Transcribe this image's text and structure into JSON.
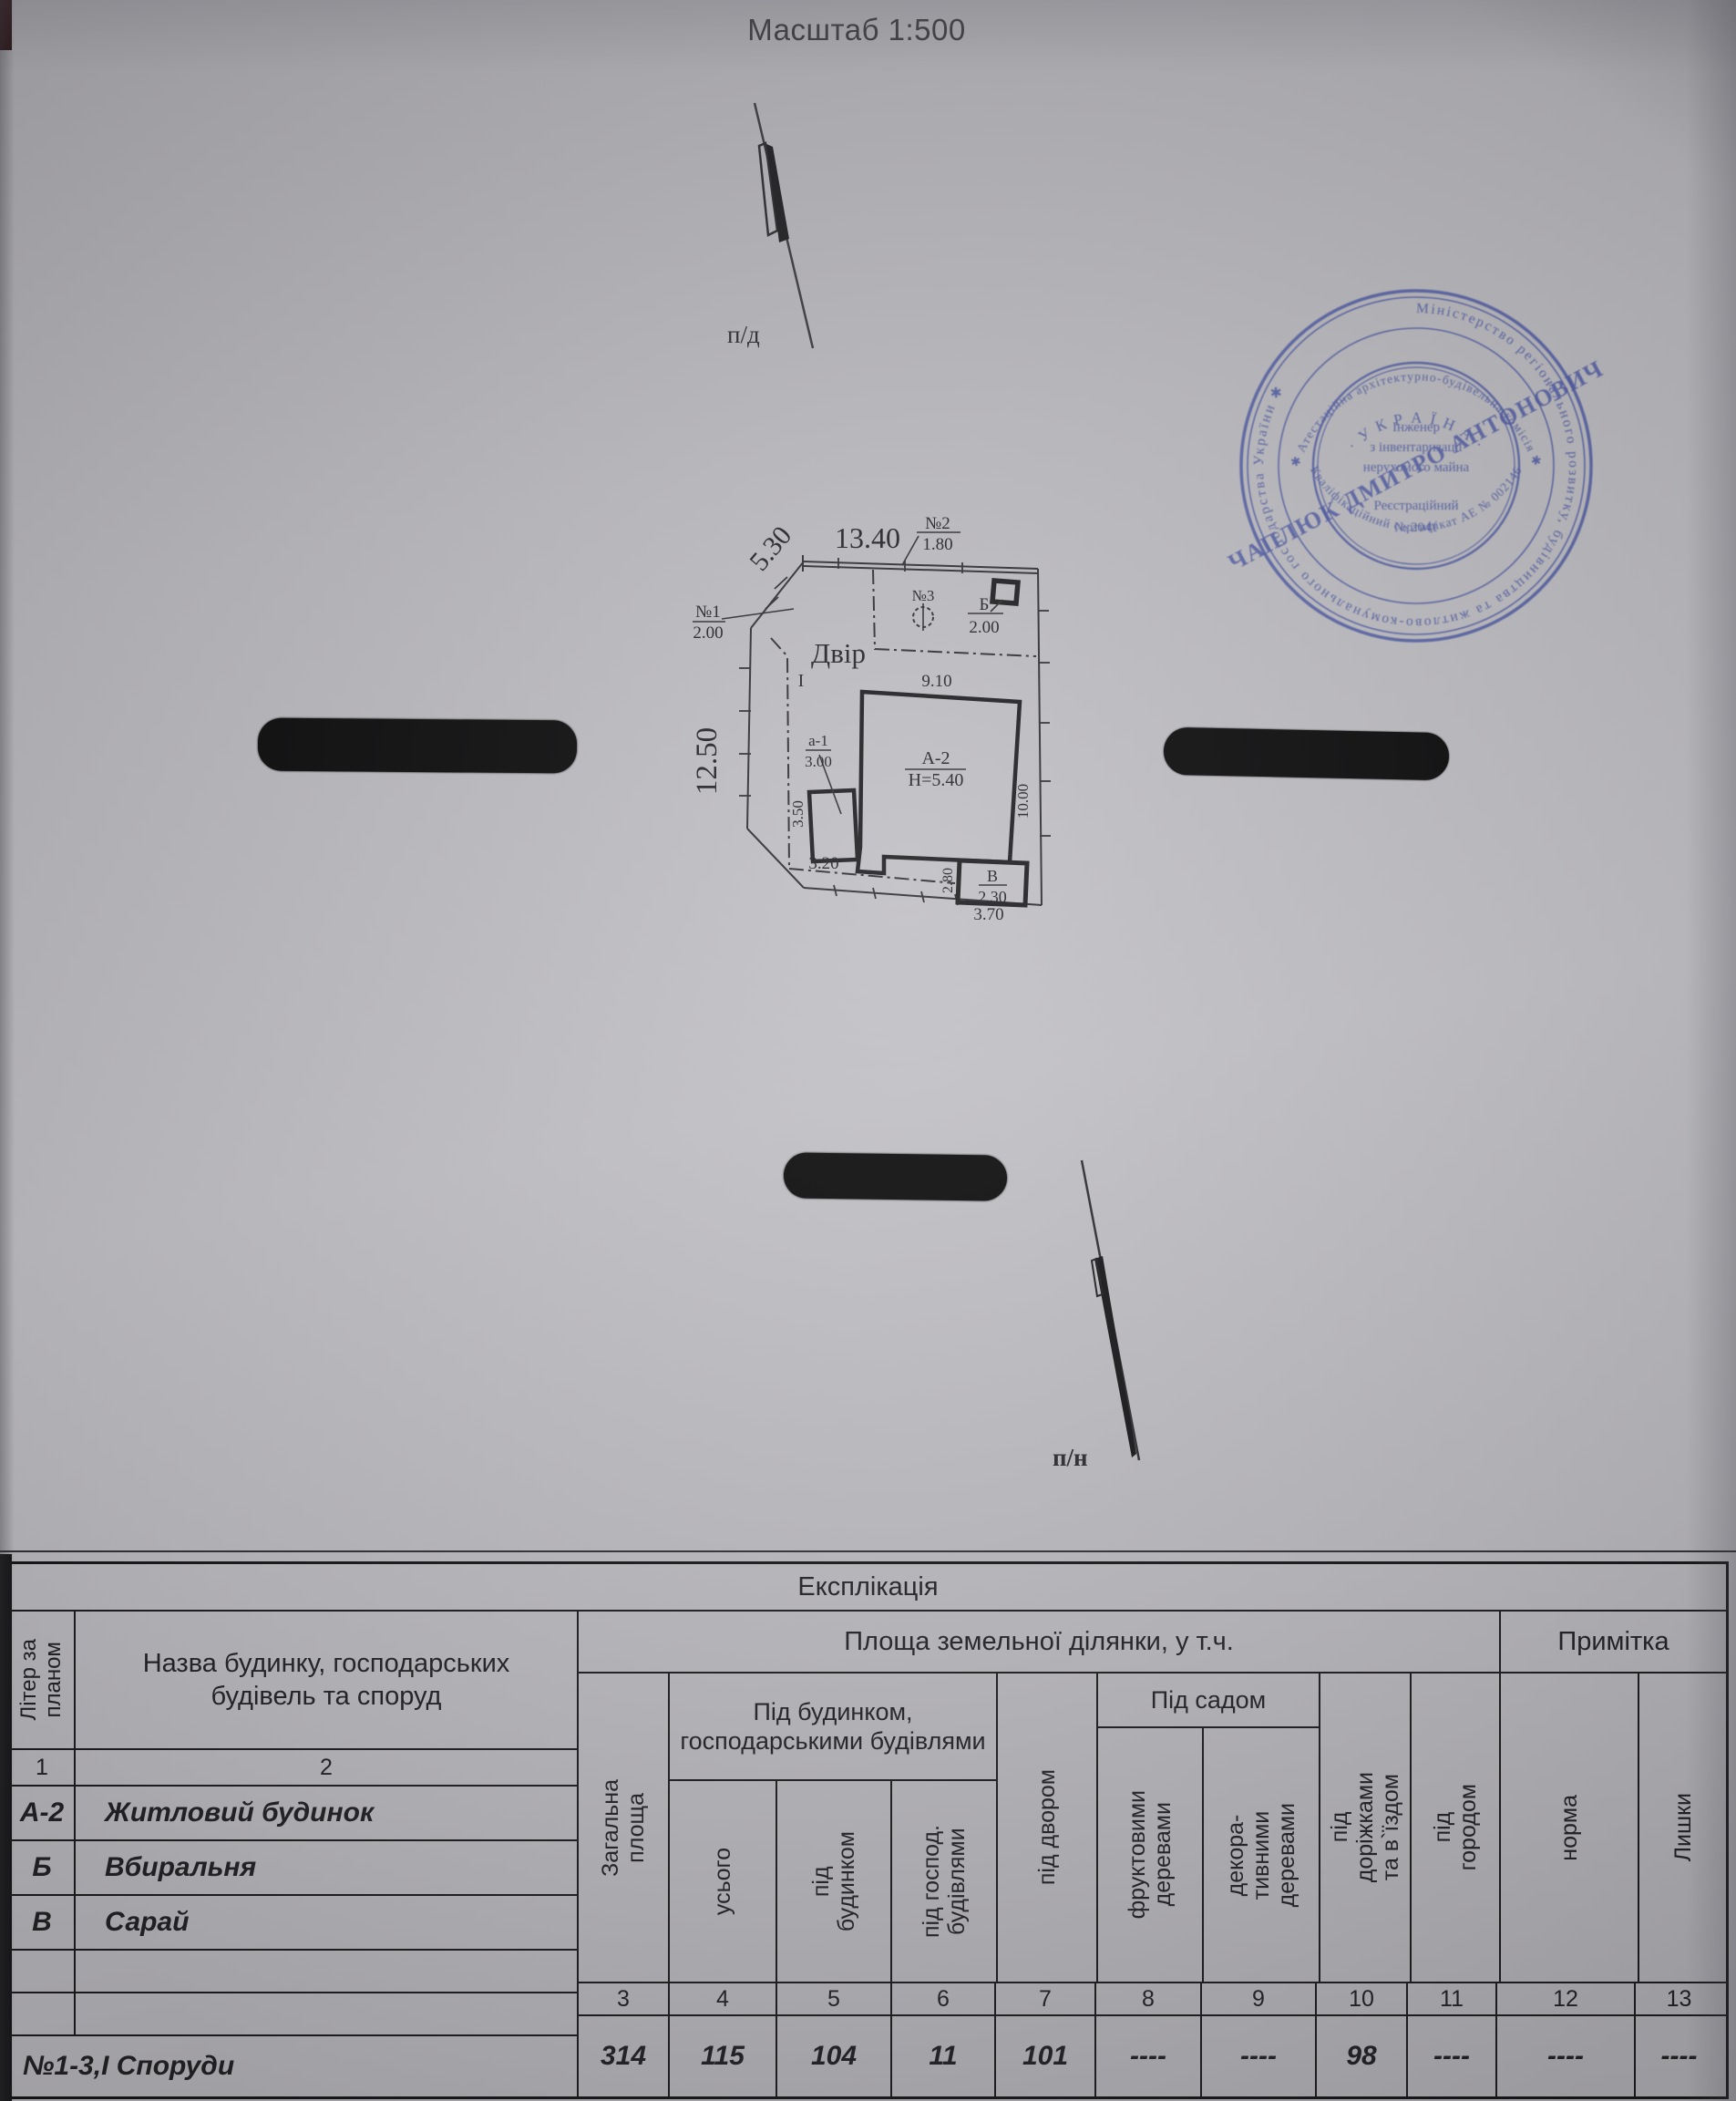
{
  "page": {
    "scale_label": "Масштаб 1:500",
    "north_top": "п/д",
    "north_bottom": "п/н"
  },
  "plan": {
    "yard": "Двір",
    "section": "I",
    "dim_top": "13.40",
    "dim_diag": "5.30",
    "p1_label": "№1",
    "p1_val": "2.00",
    "p2_label": "№2",
    "p2_val": "1.80",
    "p3_label": "№3",
    "b_label": "Б",
    "b_val": "2.00",
    "left_side": "12.50",
    "right_side": "10.00",
    "house_w": "9.10",
    "house": "А-2",
    "house_h": "Н=5.40",
    "annex": "а-1",
    "annex_val": "3.00",
    "annex_side": "3.50",
    "d320": "3.20",
    "d280": "2.80",
    "shed": "В",
    "shed_val": "2.30",
    "d370": "3.70"
  },
  "stamp": {
    "outer_ring": "Міністерство регіонального розвитку, будівництва та житлово-комунального господарства України ✱ ",
    "ring2_top": "✱ Атестаційна архітектурно-будівельна комісія ✱",
    "ring2_bottom": "Кваліфікаційний сертифікат АЕ № 002146",
    "country": "· У К Р А Ї Н А ·",
    "center1": "Інженер",
    "center2": "з інвентаризації",
    "center3": "нерухомого майна",
    "center4": "Реєстраційний",
    "center5": "№ 2041",
    "name": "ЧАПЛЮК ДМИТРО АНТОНОВИЧ",
    "color": "#4b58a2"
  },
  "table": {
    "title": "Експлікація",
    "col1_header": "Літер за\nпланом",
    "col2_header": "Назва будинку, господарських будівель та споруд",
    "area_header": "Площа земельної ділянки, у т.ч.",
    "note_header": "Примітка",
    "group_house": "Під будинком,\nгосподарськими\nбудівлями",
    "group_garden": "Під садом",
    "col3": "Загальна\nплоща",
    "col4": "усього",
    "col5": "під\nбудинком",
    "col6": "під господ.\nбудівлями",
    "col7": "під двором",
    "col8": "фруктовими\nдеревами",
    "col9": "декора-\nтивними\nдеревами",
    "col10": "під\nдоріжками\nта в`їздом",
    "col11": "під\nгородом",
    "col12": "норма",
    "col13": "Лишки",
    "num_row": [
      "1",
      "2",
      "3",
      "4",
      "5",
      "6",
      "7",
      "8",
      "9",
      "10",
      "11",
      "12",
      "13"
    ],
    "rows": [
      {
        "liter": "А-2",
        "name": "Житловий будинок"
      },
      {
        "liter": "Б",
        "name": "Вбиральня"
      },
      {
        "liter": "В",
        "name": "Сарай"
      }
    ],
    "total_label": "№1-3,І  Споруди",
    "values": [
      "314",
      "115",
      "104",
      "11",
      "101",
      "----",
      "----",
      "98",
      "----",
      "----",
      "----"
    ]
  }
}
